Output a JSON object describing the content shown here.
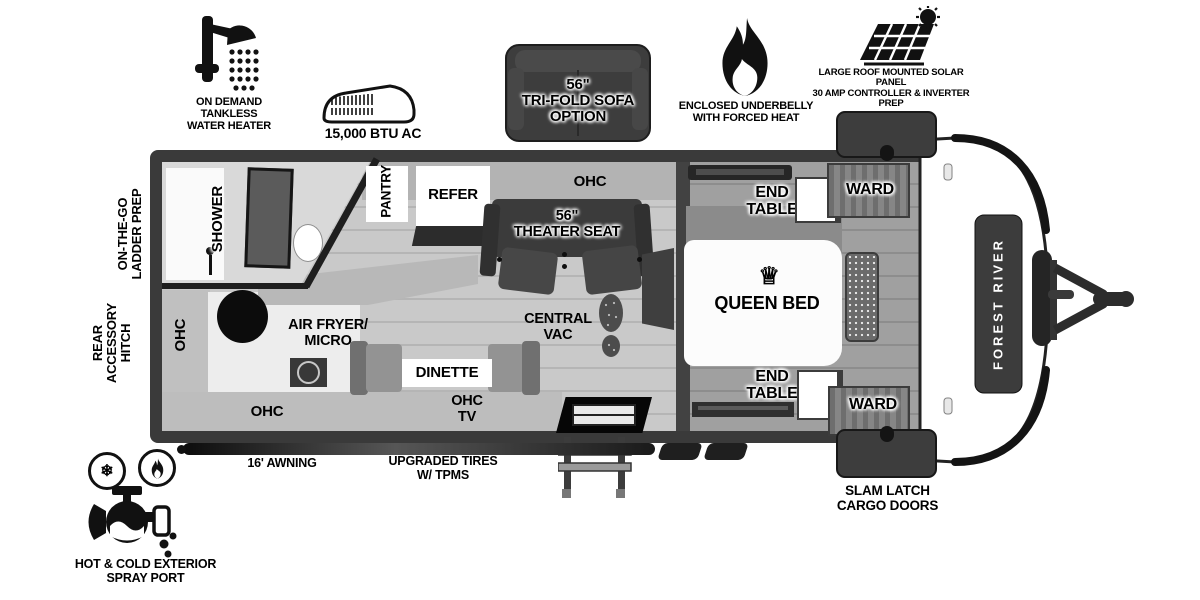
{
  "features": {
    "water_heater": "ON DEMAND\nTANKLESS\nWATER HEATER",
    "ac": "15,000 BTU AC",
    "sofa": "56\"\nTRI-FOLD SOFA\nOPTION",
    "underbelly": "ENCLOSED UNDERBELLY\nWITH FORCED HEAT",
    "solar": "LARGE ROOF MOUNTED SOLAR PANEL\n30 AMP CONTROLLER & INVERTER PREP",
    "spray_port": "HOT & COLD EXTERIOR\nSPRAY PORT"
  },
  "exterior": {
    "ladder_prep": "ON-THE-GO\nLADDER PREP",
    "rear_hitch": "REAR\nACCESSORY\nHITCH",
    "awning": "16' AWNING",
    "tires": "UPGRADED TIRES\nW/ TPMS",
    "slam_latch": "SLAM LATCH\nCARGO DOORS",
    "brand": "FOREST RIVER"
  },
  "rooms": {
    "shower": "SHOWER",
    "pantry": "PANTRY",
    "refer": "REFER",
    "ohc": "OHC",
    "theater_seat": "56\"\nTHEATER SEAT",
    "central_vac": "CENTRAL\nVAC",
    "air_fryer": "AIR FRYER/\nMICRO",
    "dinette": "DINETTE",
    "ohc_tv": "OHC\nTV",
    "queen_bed": "QUEEN BED",
    "end_table": "END\nTABLE",
    "ward": "WARD"
  },
  "icons": {
    "crown": "♕",
    "snowflake": "❄"
  },
  "colors": {
    "frame": "#3a3a3a",
    "floor": "#c9c9c9",
    "bedroom_floor": "#a0a0a0",
    "furniture_dark": "#3d3d3d",
    "white": "#ffffff"
  }
}
